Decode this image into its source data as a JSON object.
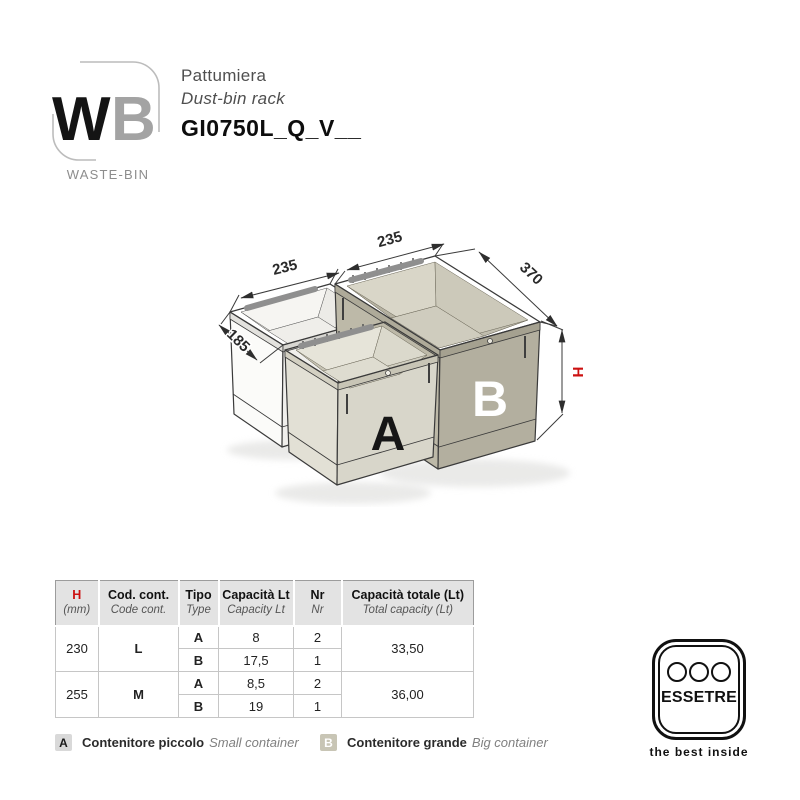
{
  "header": {
    "logo": {
      "w": "W",
      "b": "B",
      "caption": "WASTE-BIN"
    },
    "title_it": "Pattumiera",
    "title_en": "Dust-bin rack",
    "product_code": "GI0750L_Q_V__"
  },
  "drawing": {
    "dims": {
      "small_width": "235",
      "big_width": "235",
      "big_depth": "370",
      "small_depth": "185",
      "height": "H"
    },
    "bins": {
      "a": "A",
      "b": "B"
    },
    "colors": {
      "bin_beige": "#b5b1a0",
      "bin_light": "#e4e2d8",
      "height_red": "#cc1111"
    }
  },
  "table": {
    "headers": [
      {
        "main": "H",
        "sub": "(mm)"
      },
      {
        "main": "Cod. cont.",
        "sub": "Code cont."
      },
      {
        "main": "Tipo",
        "sub": "Type"
      },
      {
        "main": "Capacità Lt",
        "sub": "Capacity Lt"
      },
      {
        "main": "Nr",
        "sub": "Nr"
      },
      {
        "main": "Capacità totale (Lt)",
        "sub": "Total capacity (Lt)"
      }
    ],
    "groups": [
      {
        "h": "230",
        "code": "L",
        "total": "33,50",
        "rows": [
          {
            "tipo": "A",
            "cap": "8",
            "nr": "2"
          },
          {
            "tipo": "B",
            "cap": "17,5",
            "nr": "1"
          }
        ]
      },
      {
        "h": "255",
        "code": "M",
        "total": "36,00",
        "rows": [
          {
            "tipo": "A",
            "cap": "8,5",
            "nr": "2"
          },
          {
            "tipo": "B",
            "cap": "19",
            "nr": "1"
          }
        ]
      }
    ]
  },
  "legend": {
    "items": [
      {
        "key": "A",
        "label_it": "Contenitore piccolo",
        "label_en": "Small container"
      },
      {
        "key": "B",
        "label_it": "Contenitore grande",
        "label_en": "Big container"
      }
    ]
  },
  "footer_logo": {
    "name": "ESSETRE",
    "tagline": "the best inside"
  }
}
